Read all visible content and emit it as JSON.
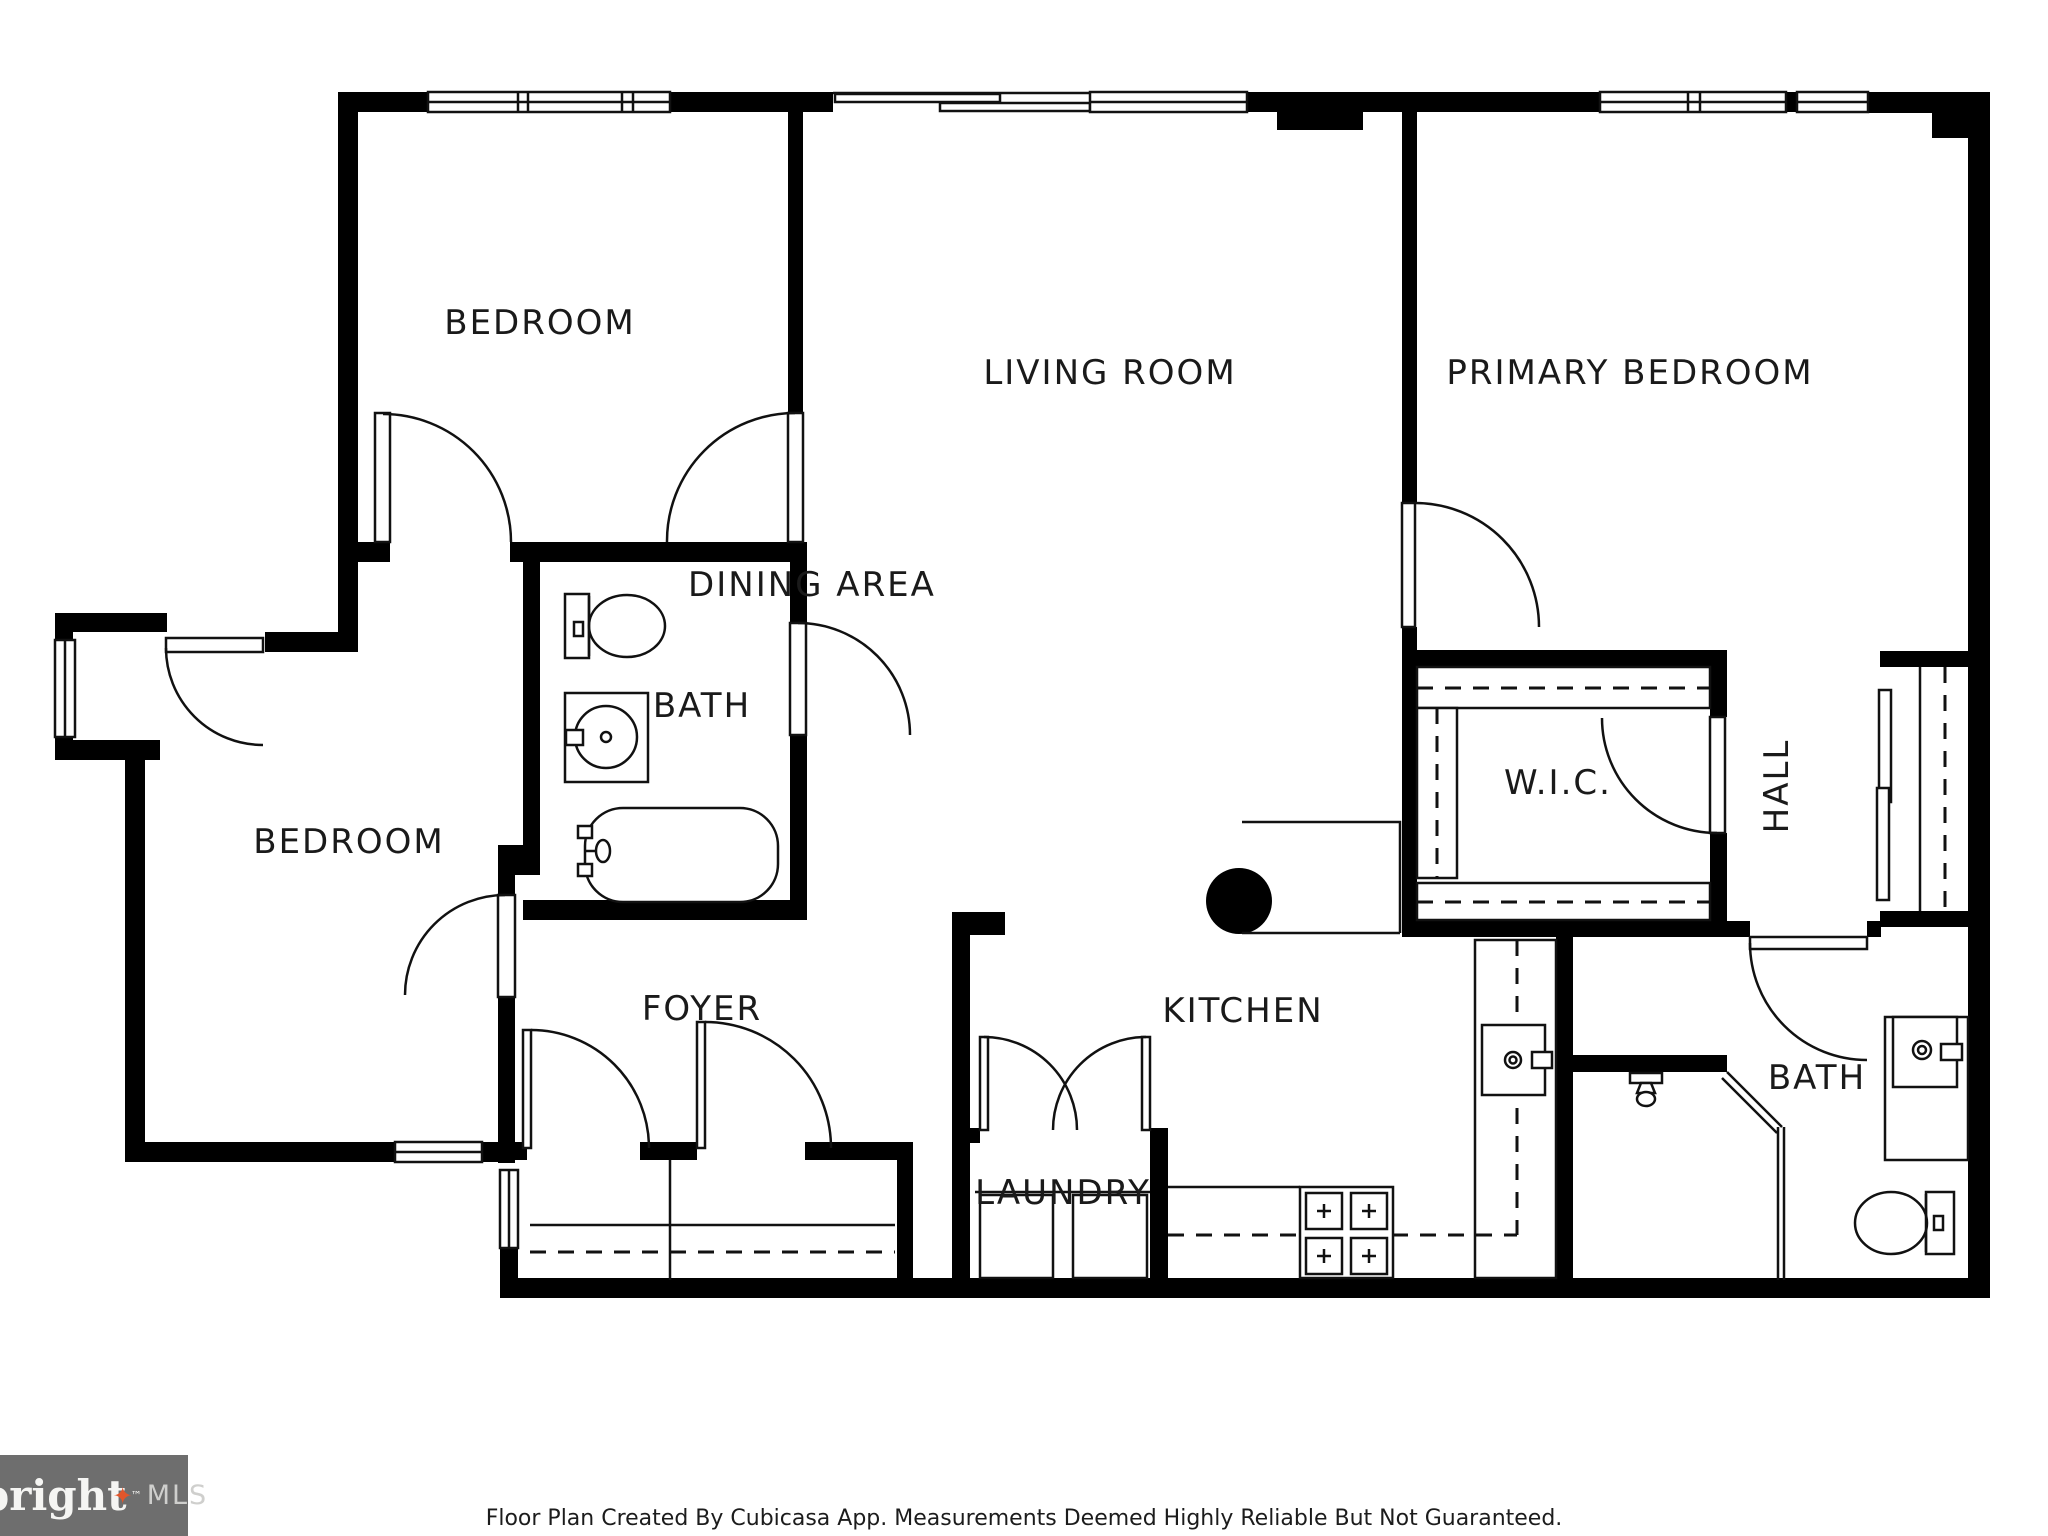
{
  "title": "Floor Plan",
  "colors": {
    "wall": "#000000",
    "lines": "#111111",
    "label_text": "#1a1a1a",
    "logo_background": "#6e6e6e",
    "logo_text": "#f5f5f3",
    "logo_mls_text": "#cfcfcd",
    "logo_star": "#e2562b"
  },
  "rooms": [
    {
      "label": "BEDROOM"
    },
    {
      "label": "LIVING ROOM"
    },
    {
      "label": "PRIMARY BEDROOM"
    },
    {
      "label": "BATH"
    },
    {
      "label": "DINING AREA"
    },
    {
      "label": "W.I.C."
    },
    {
      "label": "HALL"
    },
    {
      "label": "BEDROOM"
    },
    {
      "label": "FOYER"
    },
    {
      "label": "KITCHEN"
    },
    {
      "label": "LAUNDRY"
    },
    {
      "label": "BATH"
    }
  ],
  "fixtures": [
    "toilet",
    "sink",
    "bathtub",
    "shower",
    "stove",
    "kitchen-sink",
    "washer",
    "dryer",
    "water-heater",
    "vanity-sink",
    "toilet-2"
  ],
  "footer": {
    "disclaimer": "Floor Plan Created By Cubicasa App. Measurements Deemed Highly Reliable But Not Guaranteed."
  },
  "logo": {
    "brand": "bright",
    "star": "✦",
    "tm": "™",
    "suffix": "MLS"
  }
}
